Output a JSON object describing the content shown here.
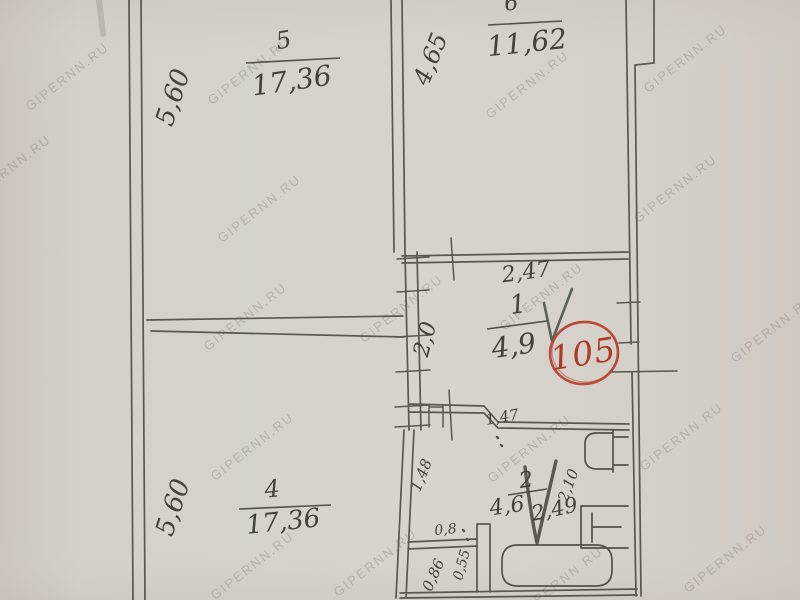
{
  "watermark": {
    "text": "GIPERNN.RU"
  },
  "stamp": {
    "number": "105",
    "color": "#b5402c"
  },
  "rooms": {
    "room5": {
      "number": "5",
      "area": "17,36"
    },
    "room6": {
      "number": "6",
      "area": "11,62"
    },
    "room1": {
      "number": "1",
      "area": "4,9"
    },
    "room4": {
      "number": "4",
      "area": "17,36"
    },
    "room2": {
      "number": "2",
      "area": "4,6",
      "area_extra": "2,49"
    }
  },
  "dimensions": {
    "room5_side": "5,60",
    "room6_side": "4,65",
    "room1_width": "2,47",
    "room1_depth": "2,0",
    "room2_width": "1,47",
    "room2_left": "1,48",
    "room2_right": "2,10",
    "niche_width": "0,8",
    "step_width": "0,55",
    "niche_depth": "0,86",
    "room4_side": "5,60"
  },
  "colors": {
    "paper": "#d6d1cb",
    "ink": "#524c45",
    "pencil": "#46413b",
    "stamp_red": "#b5402c",
    "check_green": "#4d564a",
    "watermark_gray": "#6c6760"
  }
}
